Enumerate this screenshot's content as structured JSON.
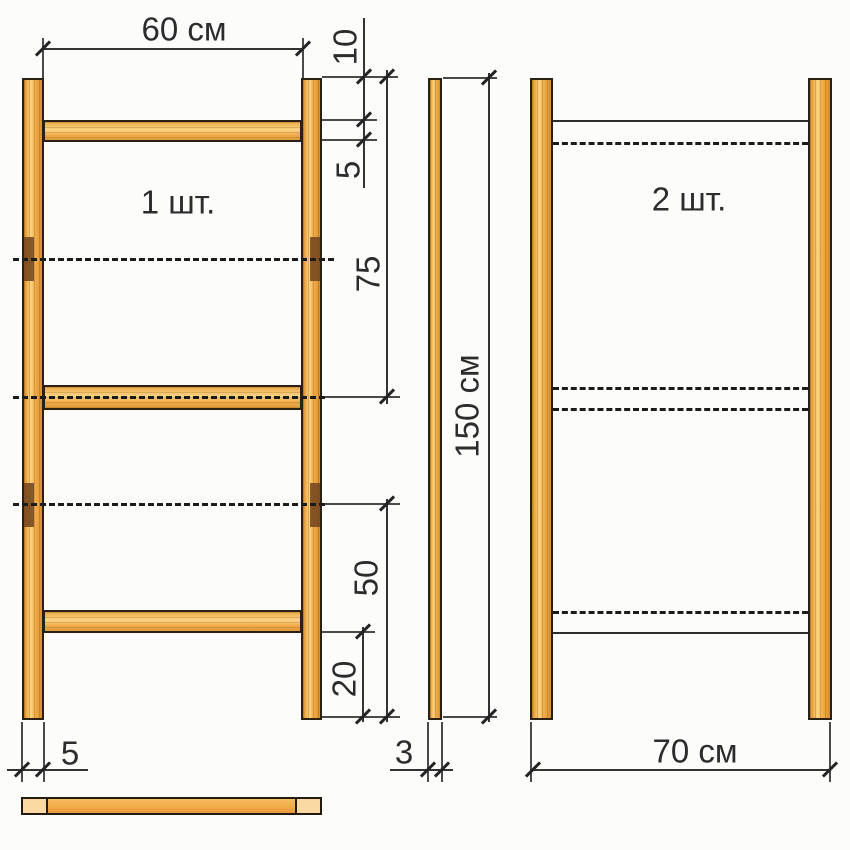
{
  "labels": {
    "frame1": "1 шт.",
    "frame2": "2 шт."
  },
  "dims": {
    "inner_width": "60 см",
    "top_offset": "10",
    "rail_thickness": "5",
    "top_to_middle": "75",
    "middle_to_bottom": "50",
    "bottom_offset": "20",
    "post_width": "5",
    "post_depth": "3",
    "post_height": "150 см",
    "outer_width": "70 см"
  },
  "colors": {
    "wood_light": "#fbd381",
    "wood_mid": "#f2b050",
    "wood_dark": "#d28f2f",
    "wood_cap_light": "#fbd9a2",
    "notch": "#74471f",
    "outline": "#2b2014",
    "line": "#2e2e2e",
    "text": "#2c2c2c",
    "background": "#fcfcfb"
  }
}
